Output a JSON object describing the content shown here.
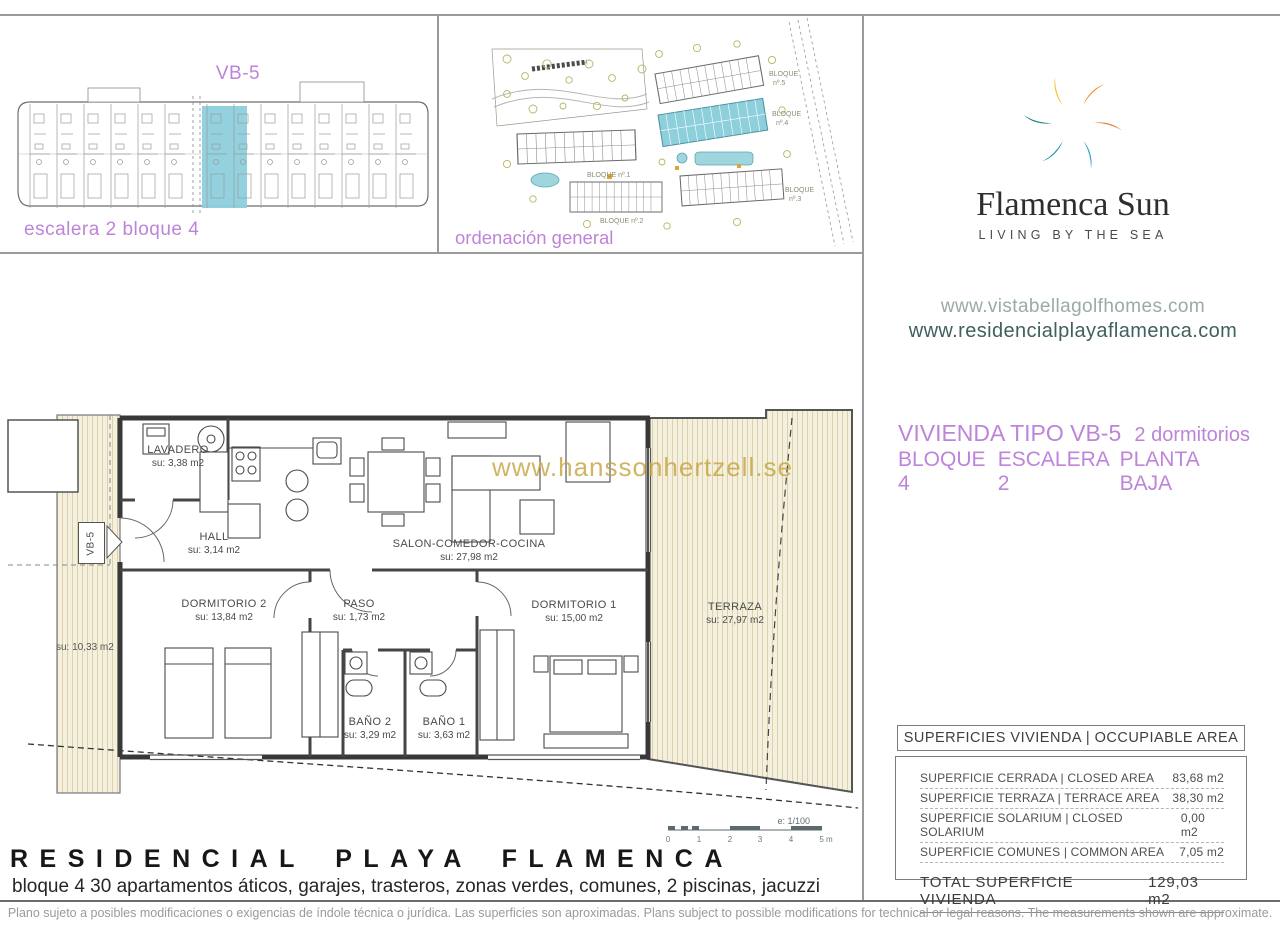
{
  "panels": {
    "elevation": {
      "title": "VB-5",
      "caption": "escalera 2 bloque 4"
    },
    "siteplan": {
      "caption": "ordenación general",
      "labels": [
        {
          "line1": "BLOQUE",
          "line2": "nº.5"
        },
        {
          "line1": "BLOQUE",
          "line2": "nº.4"
        },
        {
          "line1": "BLOQUE",
          "line2": "nº.3"
        },
        {
          "line1": "BLOQUE nº.1"
        },
        {
          "line1": "BLOQUE nº.2"
        }
      ]
    }
  },
  "brand": {
    "name": "Flamenca Sun",
    "tagline": "LIVING BY THE SEA",
    "website1": "www.vistabellagolfhomes.com",
    "website2": "www.residencialplayaflamenca.com"
  },
  "unit": {
    "type": "VIVIENDA TIPO VB-5",
    "bedrooms": "2 dormitorios",
    "block": "BLOQUE 4",
    "stair": "ESCALERA 2",
    "floor": "PLANTA BAJA"
  },
  "plan": {
    "watermark": "www.hanssonhertzell.se",
    "unit_tag": "VB-5",
    "side_area": "su: 10,33 m2",
    "rooms": [
      {
        "name": "LAVADERO",
        "area": "su: 3,38 m2"
      },
      {
        "name": "HALL",
        "area": "su: 3,14 m2"
      },
      {
        "name": "SALON-COMEDOR-COCINA",
        "area": "su: 27,98 m2"
      },
      {
        "name": "DORMITORIO 2",
        "area": "su: 13,84 m2"
      },
      {
        "name": "PASO",
        "area": "su: 1,73 m2"
      },
      {
        "name": "DORMITORIO 1",
        "area": "su: 15,00 m2"
      },
      {
        "name": "BAÑO 2",
        "area": "su: 3,29 m2"
      },
      {
        "name": "BAÑO 1",
        "area": "su: 3,63 m2"
      },
      {
        "name": "TERRAZA",
        "area": "su: 27,97 m2"
      }
    ],
    "scale": {
      "label": "e: 1/100",
      "ticks": [
        "0",
        "1",
        "2",
        "3",
        "4",
        "5 m"
      ]
    }
  },
  "areas_table": {
    "header": "SUPERFICIES VIVIENDA | OCCUPIABLE AREA",
    "rows": [
      {
        "label": "SUPERFICIE CERRADA | CLOSED AREA",
        "value": "83,68 m2"
      },
      {
        "label": "SUPERFICIE TERRAZA   | TERRACE AREA",
        "value": "38,30 m2"
      },
      {
        "label": "SUPERFICIE SOLARIUM | CLOSED SOLARIUM",
        "value": "0,00 m2"
      },
      {
        "label": "SUPERFICIE COMUNES | COMMON AREA",
        "value": "7,05 m2"
      }
    ],
    "total": {
      "label": "TOTAL SUPERFICIE VIVIENDA",
      "value": "129,03 m2"
    }
  },
  "footer": {
    "title": "RESIDENCIAL PLAYA FLAMENCA",
    "subtitle": "bloque 4 30 apartamentos áticos, garajes, trasteros, zonas verdes, comunes, 2 piscinas, jacuzzi",
    "disclaimer": "Plano sujeto a posibles modificaciones o exigencias de índole técnica o jurídica. Las superficies son aproximadas. Plans subject to possible modifications for technical or legal reasons. The measurements shown are approximate."
  },
  "colors": {
    "accent_purple": "#bd84d9",
    "highlight_teal": "#8ecfdc",
    "watermark_gold": "#c5a23e",
    "logo_palette": [
      "#ef9227",
      "#e4762c",
      "#2ea4bd",
      "#1b97a3",
      "#157f84",
      "#f3c32f"
    ]
  }
}
